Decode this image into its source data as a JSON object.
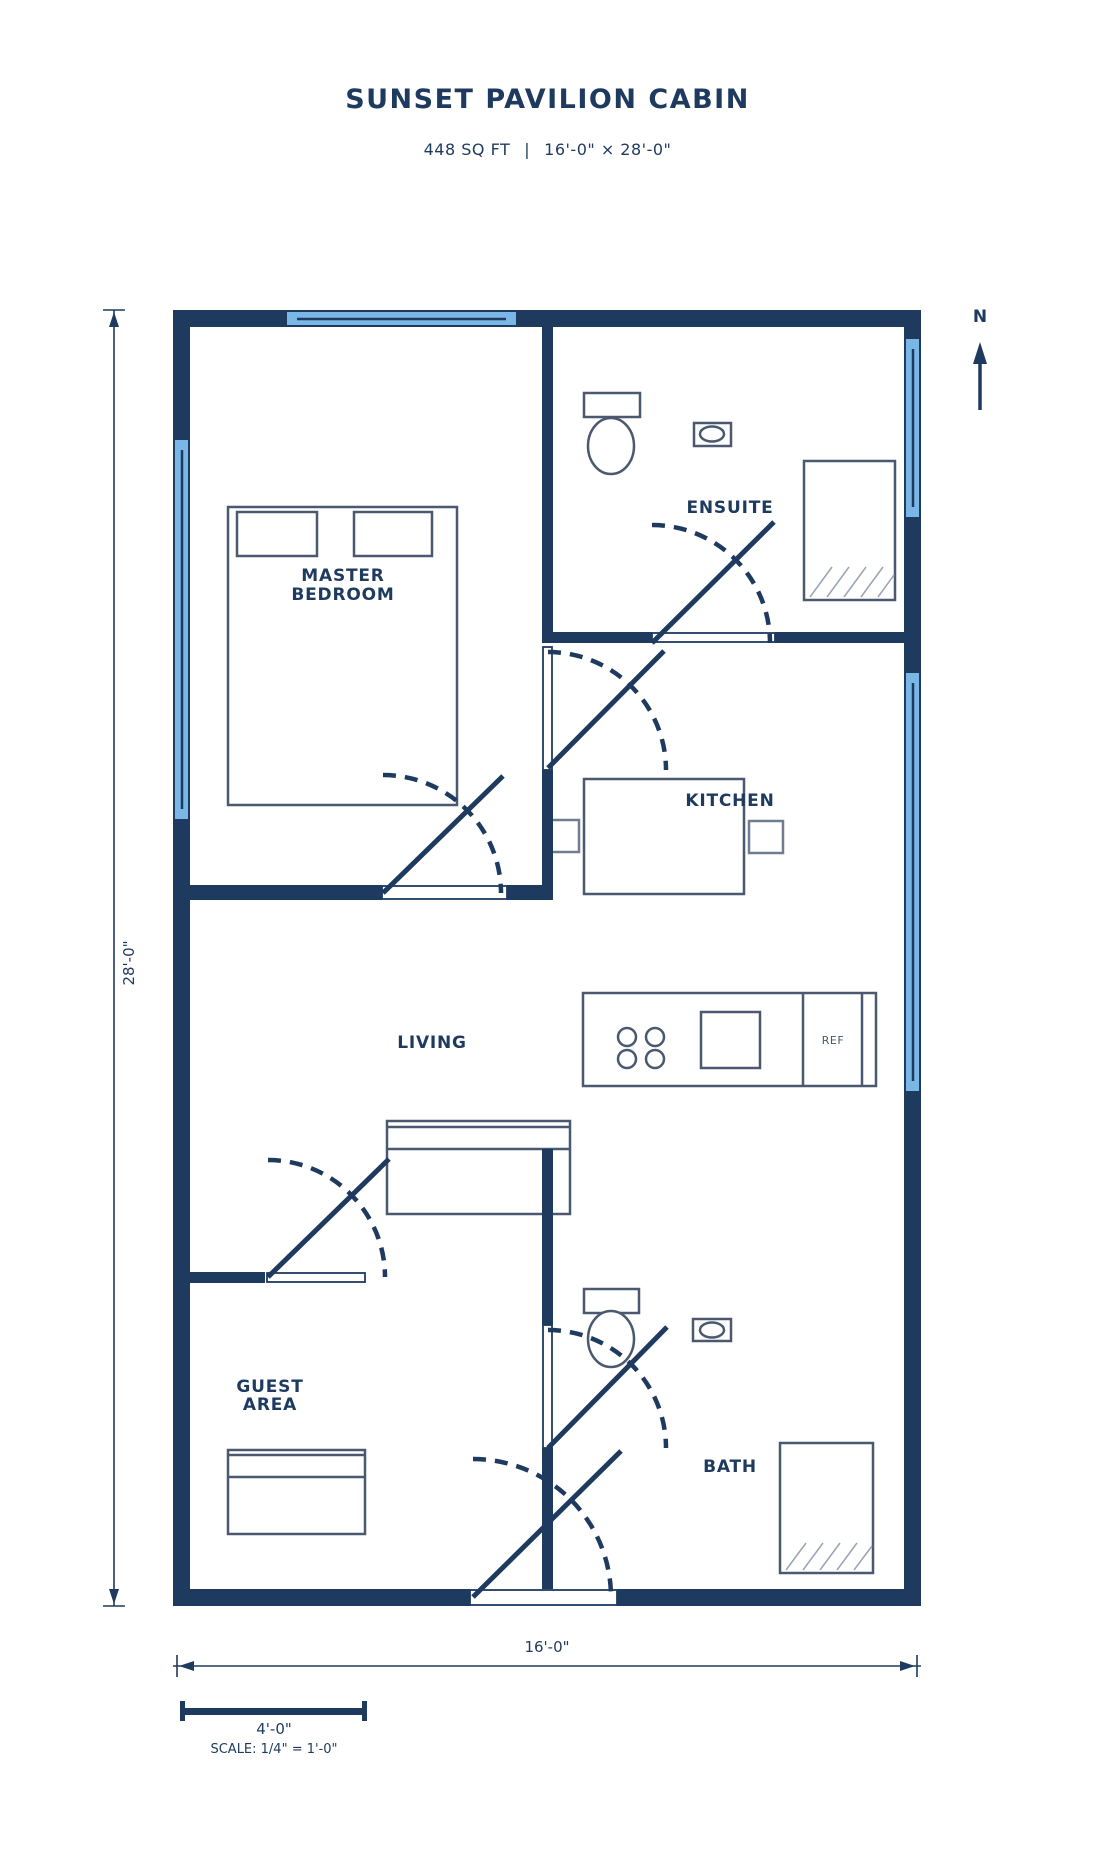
{
  "header": {
    "title": "SUNSET PAVILION CABIN",
    "area": "448 SQ FT",
    "separator": "|",
    "size": "16'-0\" × 28'-0\""
  },
  "rooms": {
    "master": {
      "line1": "MASTER",
      "line2": "BEDROOM"
    },
    "ensuite": {
      "label": "ENSUITE"
    },
    "kitchen": {
      "label": "KITCHEN"
    },
    "living": {
      "label": "LIVING"
    },
    "guest": {
      "line1": "GUEST",
      "line2": "AREA"
    },
    "bath": {
      "label": "BATH"
    }
  },
  "appliances": {
    "fridge_label": "REF"
  },
  "dimensions": {
    "height_label": "28'-0\"",
    "width_label": "16'-0\""
  },
  "scale_bar": {
    "length_label": "4'-0\"",
    "scale_label": "SCALE: 1/4\" = 1'-0\""
  },
  "compass": {
    "north_label": "N"
  },
  "colors": {
    "wall": "#1e3a5f",
    "window_fill": "#7ab6e6",
    "furniture": "#4a5870",
    "hatch": "#9aa3b5",
    "text": "#1e3a5f"
  }
}
